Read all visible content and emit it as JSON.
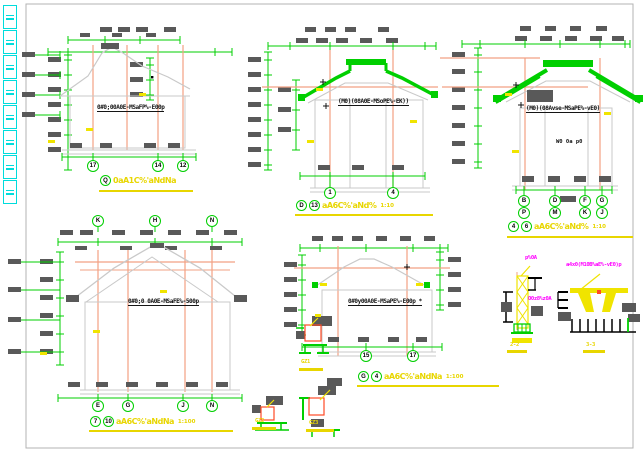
{
  "colors": {
    "green": "#00cf00",
    "orange": "#f2a183",
    "yellow": "#f0e400",
    "gray_outline": "#c9c9c9",
    "dim_block": "#595959",
    "red": "#ff4a26",
    "magenta": "#ff00ff",
    "cyan": "#00dcdc",
    "frame": "#b3b3b3",
    "background": "#ffffff"
  },
  "toolbar": {
    "buttons": [
      {
        "icon": "cad-tool-icon"
      },
      {
        "icon": "cad-tool-icon"
      },
      {
        "icon": "cad-tool-icon"
      },
      {
        "icon": "cad-tool-icon"
      },
      {
        "icon": "cad-tool-icon"
      },
      {
        "icon": "cad-tool-icon"
      },
      {
        "icon": "cad-tool-icon"
      },
      {
        "icon": "cad-tool-icon"
      }
    ]
  },
  "drawings": [
    {
      "id": "elevation-17-14-12",
      "annotation": "0#0;00A0E-MSaFP%-E00p",
      "title": {
        "circles": [
          "Q"
        ],
        "text": "0aA1C%'aNdNa",
        "scale": ""
      },
      "bubbles_bottom": [
        "17",
        "14",
        "12"
      ]
    },
    {
      "id": "elevation-1-4",
      "annotation": "(M0)(08A0E-MSoPE%-EK))",
      "title": {
        "circles": [
          "D",
          "13"
        ],
        "text": "aA6C%'aNd%",
        "scale": "1:10"
      },
      "bubbles_bottom": [
        "1",
        "4"
      ]
    },
    {
      "id": "elevation-B-G",
      "annotation": "(M0)(08Avse-MSaPE%-vE0)",
      "note": "W0 0a p0",
      "title": {
        "circles": [
          "4",
          "6"
        ],
        "text": "aA6C%'aNd%",
        "scale": "1:10"
      },
      "bubbles_row1": [
        "B",
        "D",
        "F",
        "G"
      ],
      "bubbles_row2": [
        "P",
        "M",
        "K",
        "J"
      ]
    },
    {
      "id": "elevation-7-10",
      "annotation": "0#0;0 0A0E-MSaFE%-500p",
      "title": {
        "circles": [
          "7",
          "10"
        ],
        "text": "aA6C%'aNdNa",
        "scale": "1:100"
      },
      "bubbles_top": [
        "K",
        "H",
        "N"
      ],
      "bubbles_bottom": [
        "E",
        "G",
        "J",
        "N"
      ]
    },
    {
      "id": "elevation-15-17",
      "annotation": "0#0y00A0E-MSaPE%-E00p *",
      "title": {
        "circles": [
          "G",
          "4"
        ],
        "text": "aA6C%'aNdNa",
        "scale": "1:100"
      },
      "bubbles_bottom": [
        "15",
        "17"
      ]
    }
  ],
  "details": [
    {
      "id": "column-base-detail-1",
      "label": "GZ1"
    },
    {
      "id": "column-base-detail-2",
      "label": "GZ2"
    },
    {
      "id": "column-base-detail-3",
      "label": "GZ3"
    },
    {
      "id": "section-detail-2-2",
      "label": "2-2",
      "callouts": [
        "p%0A",
        "O0z8%z0A"
      ]
    },
    {
      "id": "section-detail-3-3",
      "label": "3-3",
      "callouts": [
        "a4x0(M10B%aE%-vE0)p"
      ]
    }
  ]
}
